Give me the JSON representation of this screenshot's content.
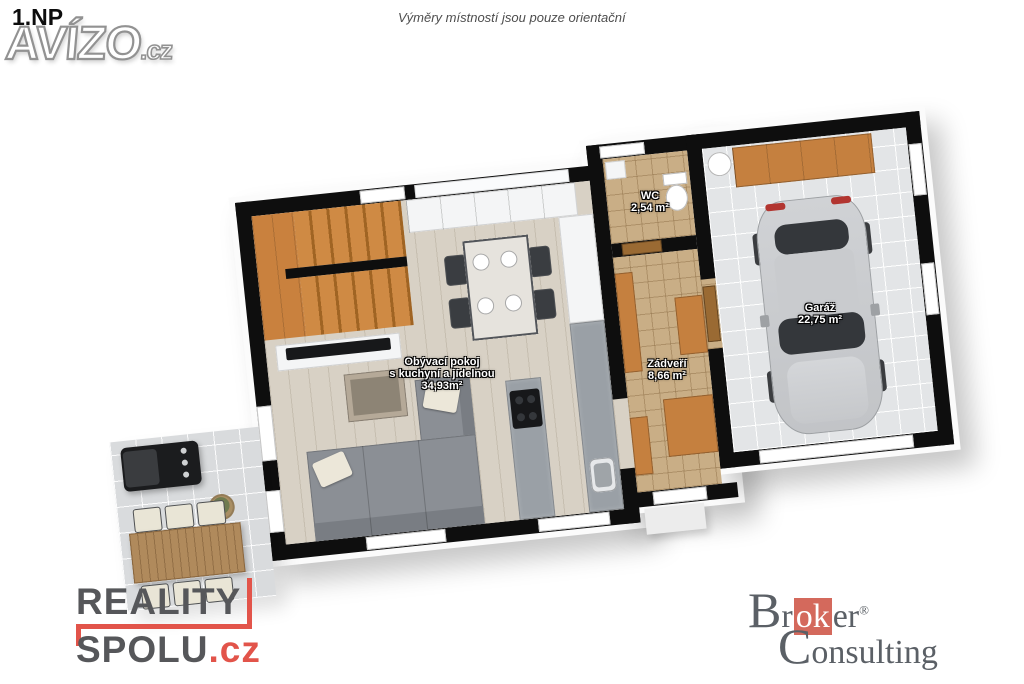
{
  "header": {
    "floor_label": "1.NP",
    "disclaimer": "Výměry místností jsou pouze orientační"
  },
  "rooms": [
    {
      "name": "Obývací pokoj",
      "subtitle": "s kuchyní a jídelnou",
      "area": "34,93m²"
    },
    {
      "name": "WC",
      "area": "2,54 m²"
    },
    {
      "name": "Zádveří",
      "area": "8,66 m²"
    },
    {
      "name": "Garáž",
      "area": "22,75 m²"
    }
  ],
  "watermarks": {
    "avizo": {
      "name": "AVÍZO",
      "tld": ".cz"
    },
    "reality_spolu": {
      "line1": "REALITY",
      "line2": "SPOLU",
      "tld": ".cz"
    },
    "broker_consulting": {
      "part1": "Br",
      "highlight": "ok",
      "part2": "er",
      "registered": "®",
      "line2": "Consulting"
    }
  },
  "colors": {
    "wall": "#0e0e0e",
    "stair_wood": "#c9813e",
    "hall_tile": "#c9ae86",
    "garage_floor": "#e3e5e7",
    "terrace_tile": "#d9dbdd",
    "reality_red": "#e2544a",
    "broker_red": "#d4695c",
    "logo_gray": "#5b6066"
  }
}
